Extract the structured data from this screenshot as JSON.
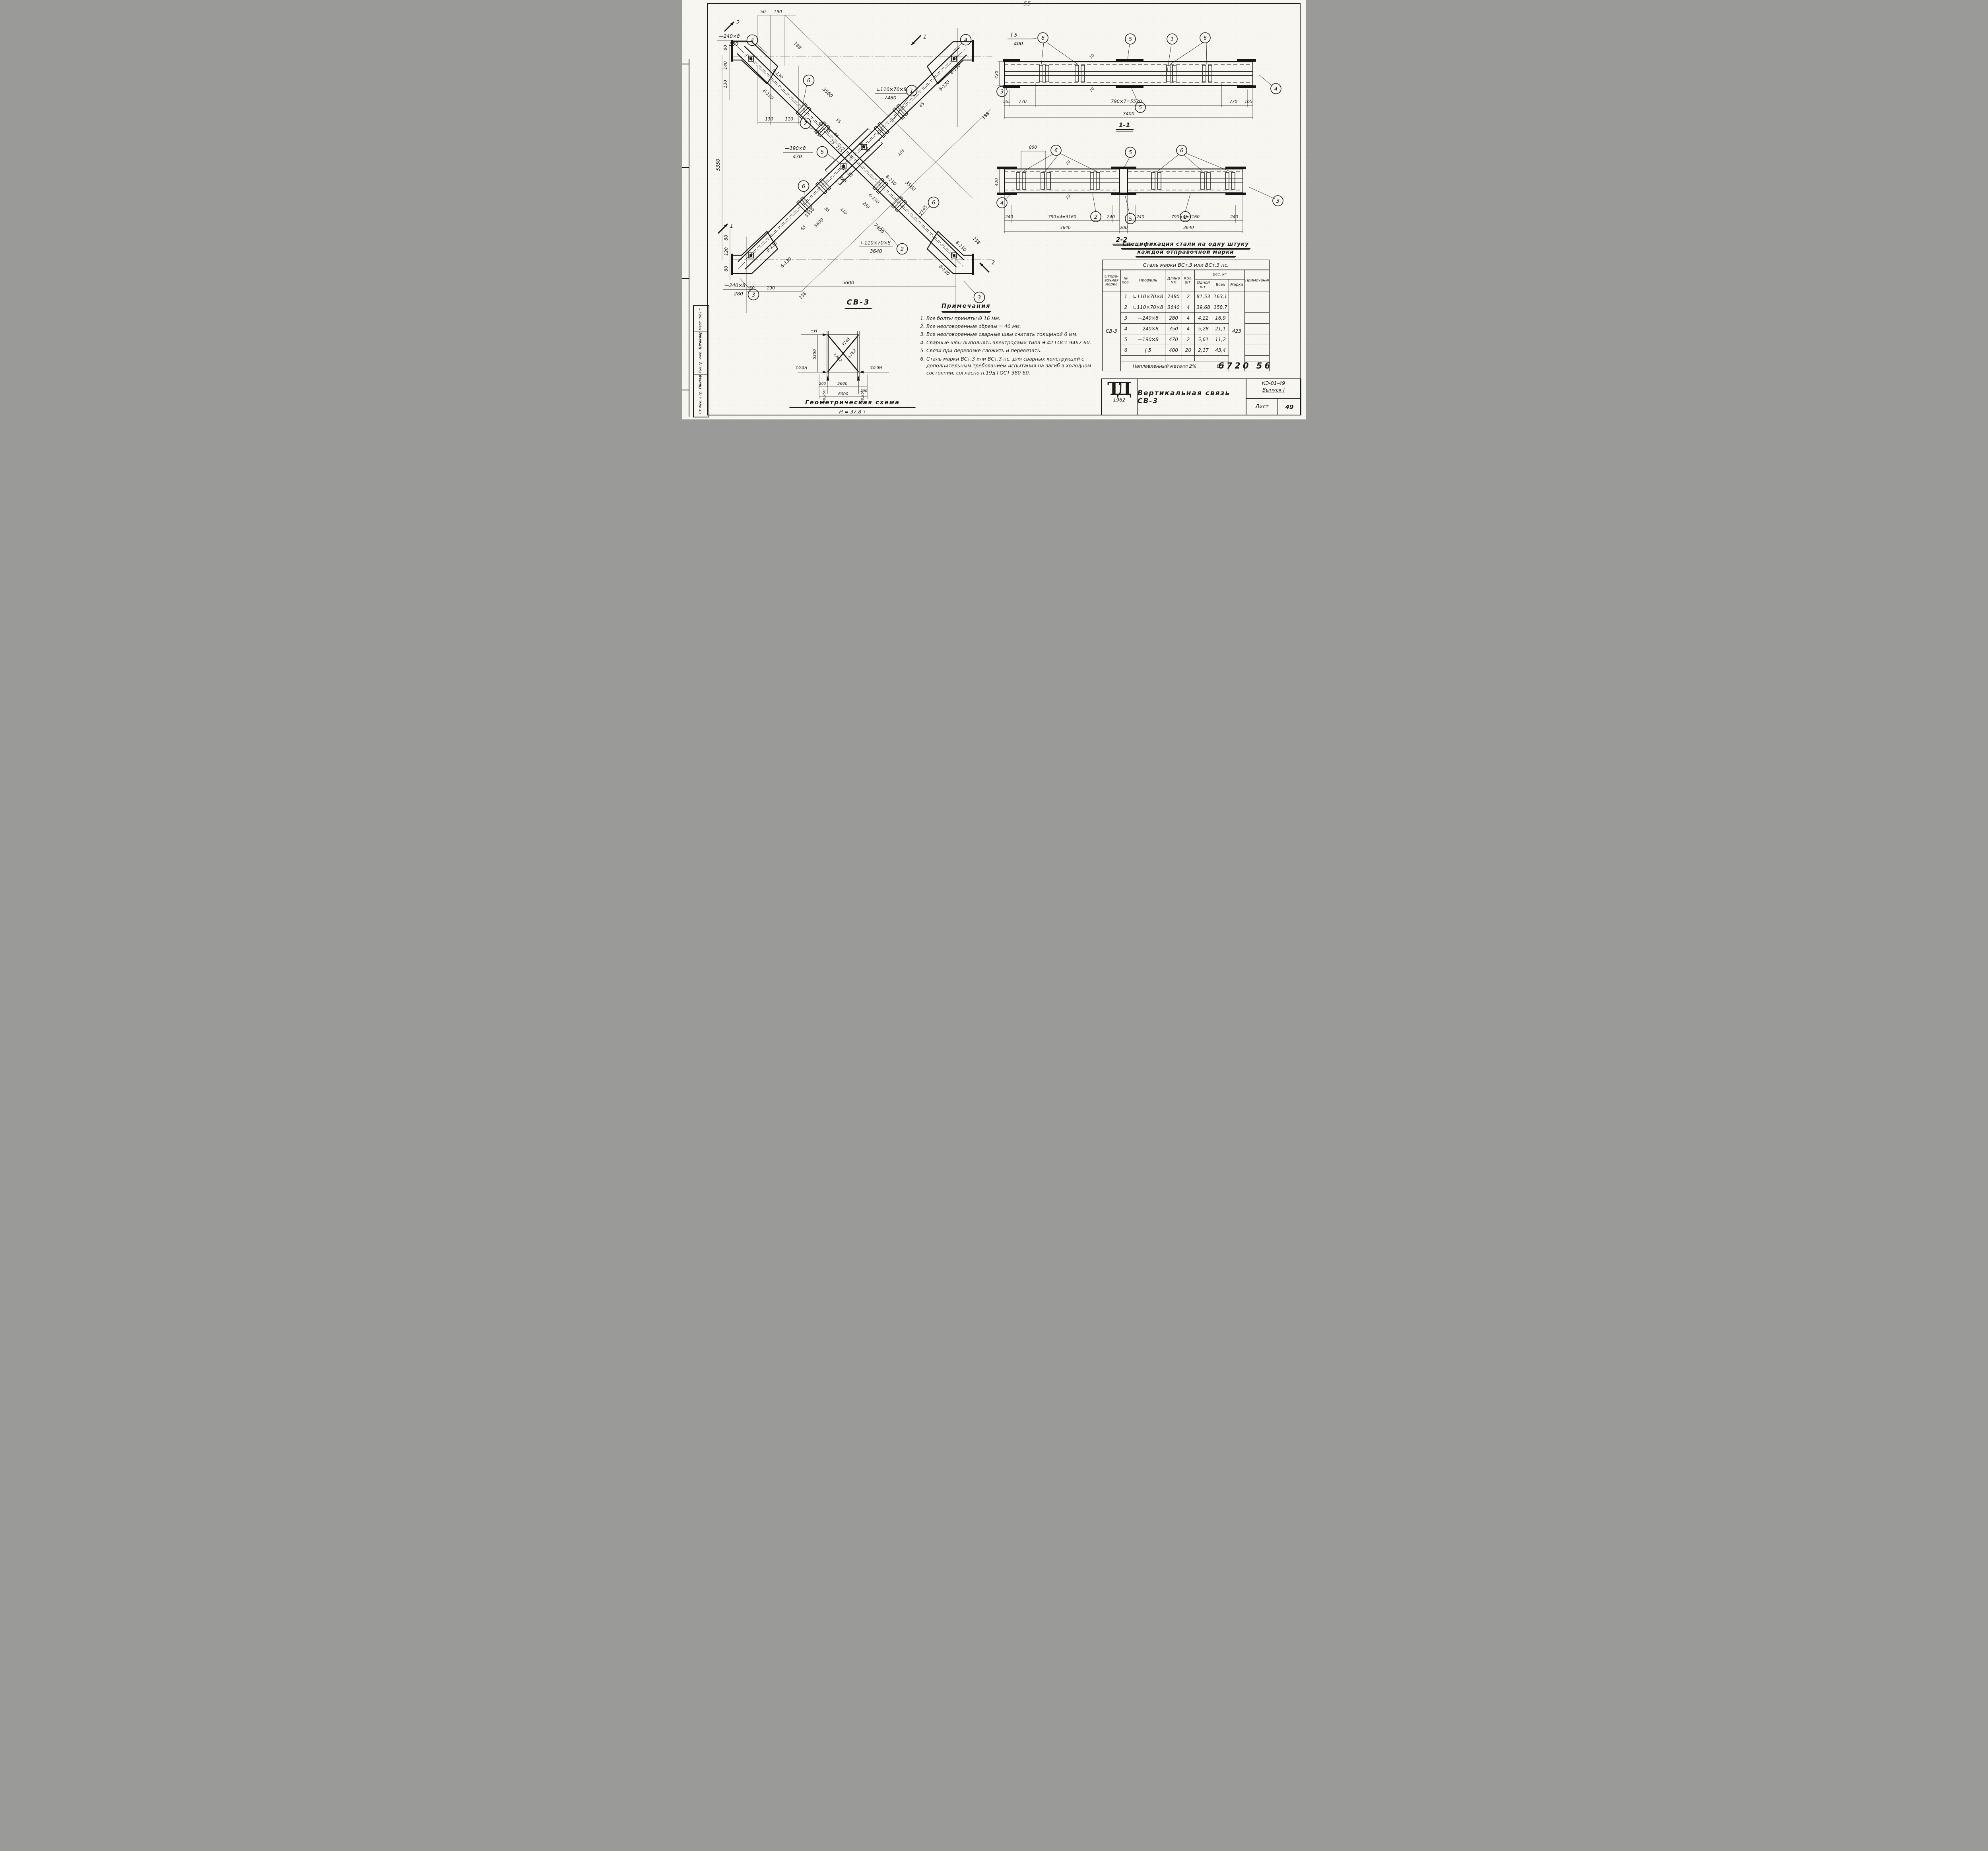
{
  "page": {
    "corner_number": "6720  56",
    "top_mark": "55"
  },
  "stamp": {
    "row1_role": "Ст.инж. II гр.",
    "row1_name": "Пингер",
    "row2_role": "Рук.гр. инж.",
    "row2_name": "Штейнер",
    "date": "Март 1962 г."
  },
  "main_view": {
    "caption": "СВ-3",
    "balloons": {
      "n1": "1",
      "n2": "2",
      "n3": "3",
      "n4": "4",
      "n5": "5",
      "n6": "6"
    },
    "callouts": {
      "pos1_profile": "∟110×70×8",
      "pos1_length": "7480",
      "pos2_profile": "∟110×70×8",
      "pos2_length": "3640",
      "pos3_profile": "—240×8",
      "pos3_length": "280",
      "pos4_profile": "—240×8",
      "pos4_length": "350",
      "pos5_profile": "—190×8",
      "pos5_length": "470"
    },
    "welds": {
      "w8": "8-130",
      "w6": "6-130"
    },
    "dims": {
      "d35": "35",
      "d45": "45",
      "d50": "50",
      "d55": "55",
      "d65": "65",
      "d75": "75",
      "d80": "80",
      "d95": "95",
      "d110": "110",
      "d115": "115",
      "d120": "120",
      "d125": "125",
      "d130": "130",
      "d140": "140",
      "d155": "155",
      "d158": "158",
      "d188": "188",
      "d190": "190",
      "d220": "220",
      "d250": "250",
      "d3560": "3560",
      "d5350": "5350",
      "d5600": "5600",
      "d7400": "7400",
      "d7745": "7745"
    },
    "section_marks": {
      "s1": "1",
      "s2": "2"
    }
  },
  "section_1_1": {
    "caption": "1-1",
    "channel_profile": "[ 5",
    "channel_length": "400",
    "dim_height": "420",
    "chain": [
      "165",
      "770",
      "790×7=5530",
      "770",
      "165"
    ],
    "total": "7400",
    "weld_size": "10"
  },
  "section_2_2": {
    "caption": "2-2",
    "dim_800": "800",
    "dim_height": "420",
    "chain_left": [
      "240",
      "790×4=3160",
      "240"
    ],
    "chain_right": [
      "240",
      "790×4=3160",
      "240"
    ],
    "chain2": [
      "3640",
      "200",
      "3640"
    ],
    "weld_size": "10"
  },
  "geometry": {
    "caption": "Геометрическая схема",
    "subtitle": "Н = 37,8 т",
    "h_top": "±Н",
    "h_half": "∓0,5Н",
    "h_095": "∓0,95Н",
    "dim_5350": "5350",
    "dim_5600": "5600",
    "dim_6000": "6000",
    "dim_200": "200",
    "diag_length": "7745",
    "force": "±26,2"
  },
  "notes": {
    "title": "Примечания",
    "items": [
      "Все болты приняты Ø 16 мм.",
      "Все неоговоренные обрезы = 40 мм.",
      "Все неоговоренные сварные швы считать толщиной 6 мм.",
      "Сварные швы выполнять электродами типа Э 42 ГОСТ 9467-60.",
      "Связи при перевозке сложить и перевязать.",
      "Сталь марки ВСт.3 или ВСт.3 пс. для сварных конструкций с дополнительным требованием испытания на загиб в холодном состоянии, согласно п.19д ГОСТ 380-60."
    ]
  },
  "spec": {
    "title_line1": "Спецификация стали на одну штуку",
    "title_line2": "каждой отправочной марки",
    "steel_header": "Сталь  марки  ВСт.3 или ВСт.3 пс.",
    "col_mark": "Отпра-вочная марка",
    "col_pos": "№ поз.",
    "col_profile": "Профиль",
    "col_length": "Длина мм",
    "col_qty": "Кол. шт.",
    "col_weight": "Вес, кг",
    "col_w_one": "Одной шт.",
    "col_w_all": "Всех",
    "col_w_mark": "Марки",
    "col_notes": "Примечания",
    "mark": "СВ-3",
    "mark_weight": "423",
    "rows": [
      {
        "pos": "1",
        "profile": "∟110×70×8",
        "length": "7480",
        "qty": "2",
        "w_one": "81,53",
        "w_all": "163,1"
      },
      {
        "pos": "2",
        "profile": "∟110×70×8",
        "length": "3640",
        "qty": "4",
        "w_one": "39,68",
        "w_all": "158,7"
      },
      {
        "pos": "3",
        "profile": "—240×8",
        "length": "280",
        "qty": "4",
        "w_one": "4,22",
        "w_all": "16,9"
      },
      {
        "pos": "4",
        "profile": "—240×8",
        "length": "350",
        "qty": "4",
        "w_one": "5,28",
        "w_all": "21,1"
      },
      {
        "pos": "5",
        "profile": "—190×8",
        "length": "470",
        "qty": "2",
        "w_one": "5,61",
        "w_all": "11,2"
      },
      {
        "pos": "6",
        "profile": "[ 5",
        "length": "400",
        "qty": "20",
        "w_one": "2,17",
        "w_all": "43,4"
      }
    ],
    "footer_label": "Наплавленный металл 2%",
    "footer_value": "8,2"
  },
  "titleblock": {
    "logo": "ТД",
    "logo_year": "1962",
    "title": "Вертикальная связь СВ-3",
    "doc_number": "КЭ-01-49",
    "doc_issue": "Выпуск I",
    "sheet_label": "Лист",
    "sheet_number": "49"
  }
}
